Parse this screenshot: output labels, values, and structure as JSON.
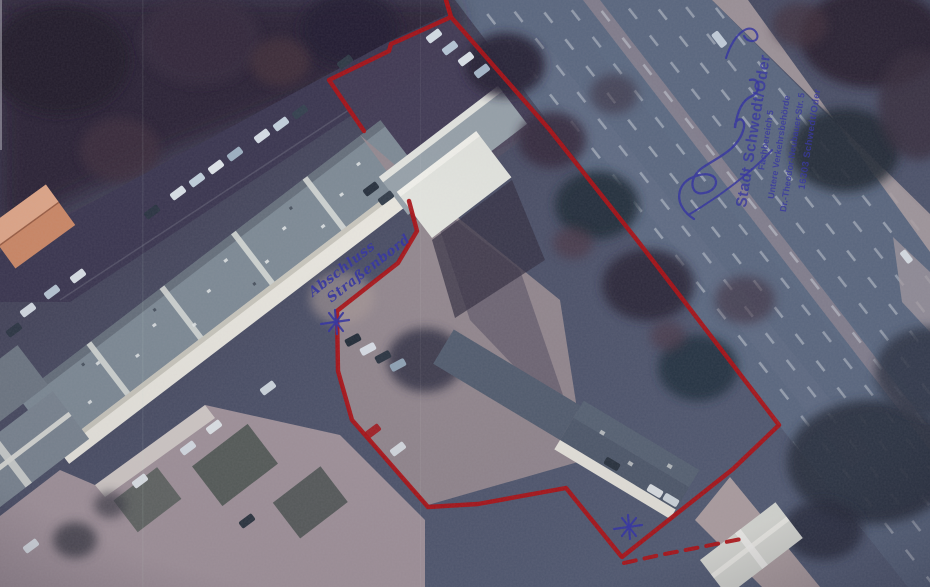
{
  "overlay": {
    "ink_color": "#32329e",
    "boundary": {
      "color": "#a80f13",
      "solid_paths": [
        [
          [
            446,
            0
          ],
          [
            451,
            17
          ],
          [
            398,
            41
          ],
          [
            391,
            44
          ],
          [
            389,
            51
          ],
          [
            329,
            80
          ],
          [
            364,
            131
          ]
        ],
        [
          [
            409,
            201
          ],
          [
            417,
            231
          ],
          [
            398,
            263
          ],
          [
            337,
            311
          ],
          [
            338,
            371
          ],
          [
            352,
            420
          ],
          [
            428,
            507
          ],
          [
            478,
            504
          ],
          [
            566,
            488
          ],
          [
            621,
            556
          ]
        ],
        [
          [
            446,
            0
          ],
          [
            451,
            17
          ],
          [
            549,
            129
          ],
          [
            637,
            240
          ],
          [
            684,
            301
          ],
          [
            779,
            425
          ],
          [
            733,
            469
          ],
          [
            622,
            557
          ]
        ]
      ],
      "dashed_path": [
        [
          624,
          563
        ],
        [
          660,
          555
        ],
        [
          696,
          548
        ],
        [
          746,
          538
        ]
      ],
      "stars": [
        [
          336,
          322
        ],
        [
          629,
          527
        ]
      ]
    },
    "handwriting": {
      "line1": "Abschluss",
      "line2": "Straßenbord"
    },
    "stamp": {
      "lines": [
        "Stadt Schwedt/Oder",
        "Fachbereich 5",
        "Untere Verkehrsbehörde",
        "Dr.-Theodor-Neubauer-Str. 5",
        "16303 Schwedt/Oder"
      ]
    }
  }
}
